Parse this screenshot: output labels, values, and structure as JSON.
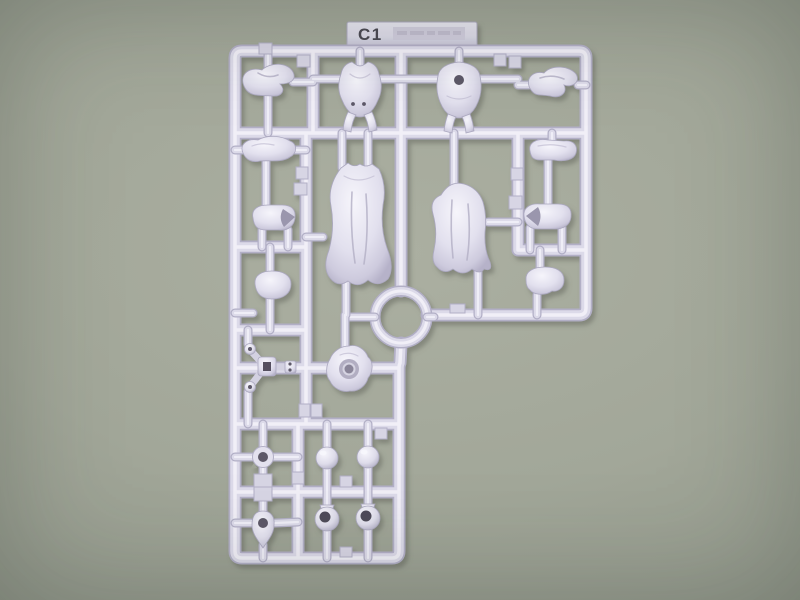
{
  "sprue": {
    "tab_label": "C1",
    "embossed_text_legible": false,
    "parts": [
      {
        "name": "curl-piece-top-left"
      },
      {
        "name": "torso-vest-with-straps"
      },
      {
        "name": "torso-vest-with-hole"
      },
      {
        "name": "curl-piece-top-right"
      },
      {
        "name": "shoe-piece-left"
      },
      {
        "name": "forearm-piece-right"
      },
      {
        "name": "cuff-open-right"
      },
      {
        "name": "cuff-open-left"
      },
      {
        "name": "skirt-large-left"
      },
      {
        "name": "skirt-large-right"
      },
      {
        "name": "pillow-piece-left"
      },
      {
        "name": "pillow-piece-right"
      },
      {
        "name": "tripod-joint-piece"
      },
      {
        "name": "rosette-socket-piece"
      },
      {
        "name": "small-ring-piece"
      },
      {
        "name": "keyhole-ring-piece"
      },
      {
        "name": "ball-joint-1"
      },
      {
        "name": "ball-joint-2"
      },
      {
        "name": "socket-ball-1"
      },
      {
        "name": "socket-ball-2"
      }
    ]
  },
  "colors": {
    "background": "#a2a799",
    "background_edge": "#878c80",
    "plastic": "#dcdae9",
    "plastic_highlight": "#f1f0f8",
    "plastic_shadow": "#b2afc6",
    "hole": "#5d5968",
    "label_text": "#4b4a52"
  }
}
